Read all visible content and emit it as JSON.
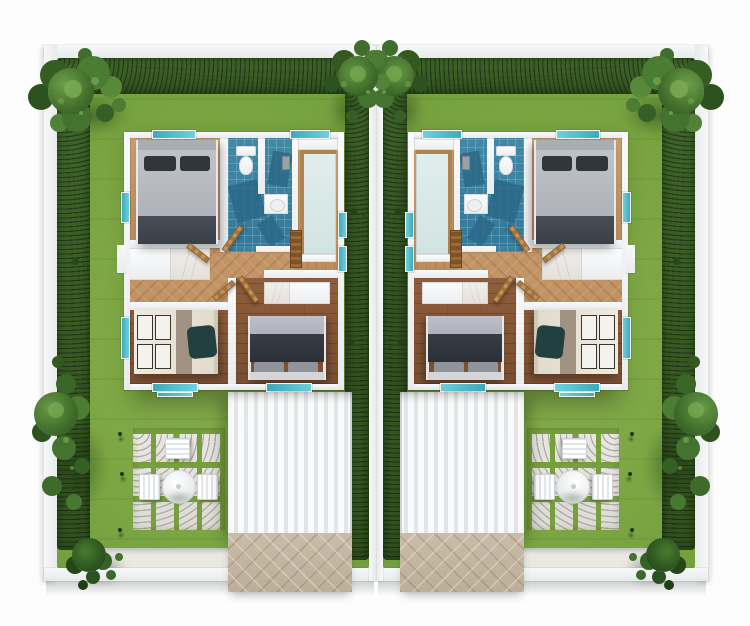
{
  "scene": {
    "type": "3d-top-down-floor-plan-render",
    "description": "Aerial 3D render of a mirrored duplex: two identical walled garden plots, each with a furnished single-storey house, hedges, trees, stepping-stone patio with table set, ribbed carport roof and paved driveway",
    "width_px": 750,
    "height_px": 626,
    "visible_text": ""
  },
  "colors": {
    "lawn": "#79a441",
    "hedge": "#3a5c26",
    "wall": "#f2f3f5",
    "wall_shade": "#d9dcde",
    "wood_hall": "#c6996b",
    "wood_light": "#c99d6f",
    "wood_dark": "#8a5a3a",
    "tile": "#3f88a5",
    "tile_dark": "#2a6886",
    "counter": "#dcebe8",
    "carport": "#f3f4f5",
    "driveway": "#c3b6a2",
    "stone": "#e6e5e0",
    "window": "#4ab6c6",
    "door_wood": "#b6854e",
    "bed_gray": "#b8bcc2",
    "bed_dark": "#43474f",
    "pillow_dark": "#31353c",
    "bed_cream": "#e7e2d6",
    "marble": "#edebe7",
    "white_furn": "#fafbfc",
    "page": "#fdfdfe"
  },
  "plots": [
    {
      "id": "plot-left",
      "left_px": 42,
      "mirrored": false
    },
    {
      "id": "plot-right",
      "left_px": 376,
      "mirrored": true
    }
  ],
  "house": {
    "rooms": [
      "bedroom-top",
      "bathroom",
      "kitchen-living",
      "hallway",
      "bedroom-bottom-left",
      "bedroom-bottom-right"
    ],
    "fixtures": [
      "toilet",
      "sink-vanity",
      "shower-fixture",
      "ladder-shelf",
      "wardrobe-cabinet",
      "desk"
    ],
    "beds": 3,
    "wooden_doors": 4,
    "teal_windows": 9
  },
  "garden": {
    "features": [
      "lawn",
      "perimeter-hedge",
      "stepping-stone-patio",
      "round-table-set",
      "carport-roof",
      "paved-driveway",
      "corner-trees",
      "shrubs"
    ],
    "table_chairs": 3,
    "stepping_stone_grid": "5x3"
  }
}
